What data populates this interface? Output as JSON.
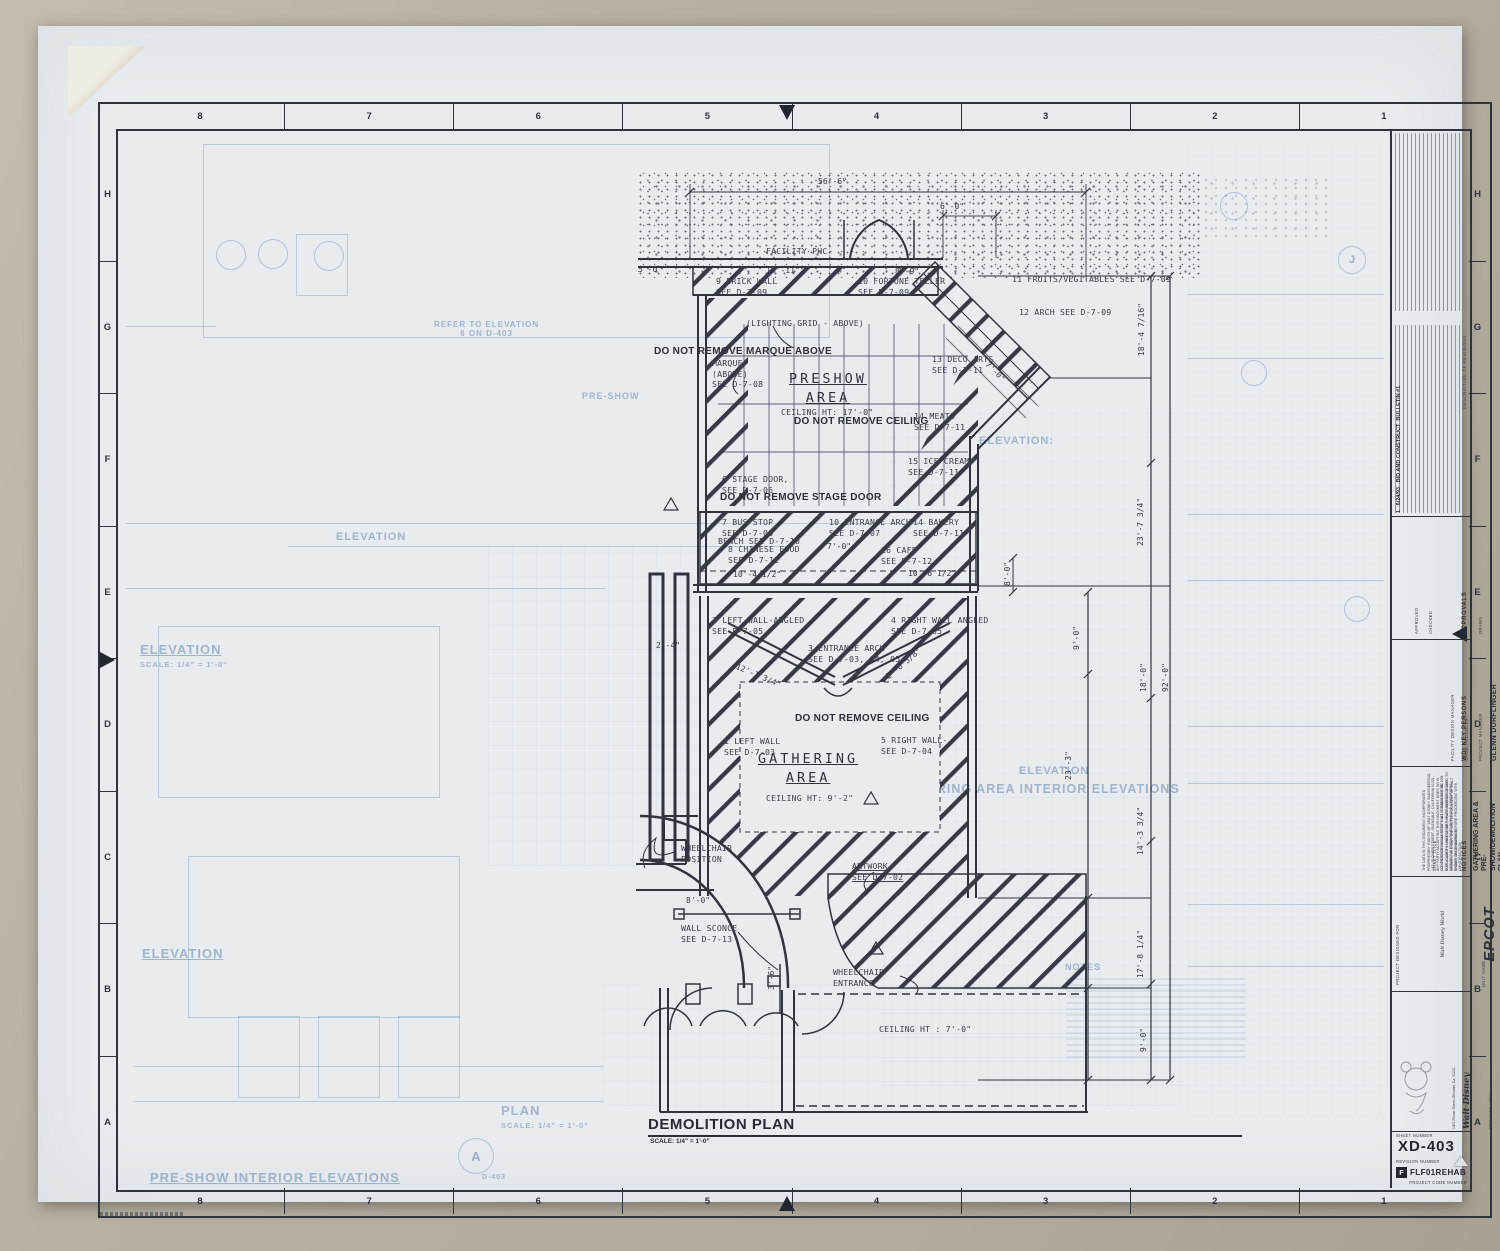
{
  "colors": {
    "ink": "#2f333c",
    "sheet": "#e9ecef",
    "underlay": "#7d9ec4",
    "photo_bg": "#b5afa2"
  },
  "border": {
    "top_numbers": [
      "8",
      "7",
      "6",
      "5",
      "4",
      "3",
      "2",
      "1"
    ],
    "bottom_numbers": [
      "8",
      "7",
      "6",
      "5",
      "4",
      "3",
      "2",
      "1"
    ],
    "left_letters": [
      "H",
      "G",
      "F",
      "E",
      "D",
      "C",
      "B",
      "A"
    ],
    "right_letters": [
      "H",
      "G",
      "F",
      "E",
      "D",
      "C",
      "B",
      "A"
    ]
  },
  "plan": {
    "annotations": [
      {
        "text": "56'-6\""
      },
      {
        "text": "6'-0\""
      },
      {
        "text": "FACILITY PHC"
      },
      {
        "text": "5'-0\""
      },
      {
        "text": "14'-11\""
      },
      {
        "text": "8'-9\""
      },
      {
        "text": "9  BRICK WALL\nSEE D-7-09"
      },
      {
        "text": "10  FORTUNE TELLER\nSEE D-7-09"
      },
      {
        "text": "11  FRUITS/VEGITABLES  SEE D-7-09"
      },
      {
        "text": "12  ARCH    SEE D-7-09"
      },
      {
        "text": "(LIGHTING GRID - ABOVE)"
      },
      {
        "text": "DO NOT REMOVE MARQUE ABOVE"
      },
      {
        "text": "MARQUE\n(ABOVE)\nSEE D-7-08"
      },
      {
        "text": "PRESHOW\nAREA"
      },
      {
        "text": "CEILING HT: 17'-0\""
      },
      {
        "text": "13  DECO ARTS\nSEE D-7-11"
      },
      {
        "text": "7'-0\""
      },
      {
        "text": "DO NOT REMOVE CEILING"
      },
      {
        "text": "14  MEATS\nSEE D-7-11"
      },
      {
        "text": "15  ICE CREAM\nSEE D-7-11"
      },
      {
        "text": "6  STAGE DOOR,\nSEE  D-7-06"
      },
      {
        "text": "DO NOT REMOVE STAGE DOOR"
      },
      {
        "text": "7  BUS STOP\nSEE  D-7-06"
      },
      {
        "text": "BENCH  SEE D-7-10"
      },
      {
        "text": "8  CHINESE FOOD\nSEE D-7-12"
      },
      {
        "text": "10  ENTRANCE ARCH\nSEE  D-7-07"
      },
      {
        "text": "7'-0\""
      },
      {
        "text": "14  BAKERY\nSEE D-7-11"
      },
      {
        "text": "16  CAFE\nSEE  D-7-12"
      },
      {
        "text": "10'-4 1/2\""
      },
      {
        "text": "10'-6 1/2\""
      },
      {
        "text": "8'-0\""
      },
      {
        "text": "2  LEFT WALL-ANGLED\nSEE D-7-05"
      },
      {
        "text": "4  RIGHT WALL ANGLED\nSEE D-7-05"
      },
      {
        "text": "2'-4\""
      },
      {
        "text": "12'-1 3/4\""
      },
      {
        "text": "3  ENTRANCE ARCH\nSEE D-7-03, 04, 05"
      },
      {
        "text": "2'-6 5/8\""
      },
      {
        "text": "9'-0\""
      },
      {
        "text": "DO NOT REMOVE CEILING"
      },
      {
        "text": "1  LEFT WALL\nSEE  D-7-03"
      },
      {
        "text": "5  RIGHT WALL-\nSEE  D-7-04"
      },
      {
        "text": "GATHERING\nAREA"
      },
      {
        "text": "CEILING HT:  9'-2\""
      },
      {
        "text": "23'-3\""
      },
      {
        "text": "WHEELCHAIR\nPOSITION"
      },
      {
        "text": "ARTWORK\nSEE D-7-02"
      },
      {
        "text": "8'-0\""
      },
      {
        "text": "WALL SCONCE\nSEE  D-7-13"
      },
      {
        "text": "3'-6\""
      },
      {
        "text": "WHEELCHAIR\nENTRANCE"
      },
      {
        "text": "CEILING HT : 7'-0\""
      },
      {
        "text": "18'-4 7/16\""
      },
      {
        "text": "23'-7 3/4\""
      },
      {
        "text": "18'-0\""
      },
      {
        "text": "92'-0\""
      },
      {
        "text": "14'-3 3/4\""
      },
      {
        "text": "17'-8 1/4\""
      },
      {
        "text": "9'-0\""
      },
      {
        "text": "DEMOLITION PLAN"
      },
      {
        "text": "SCALE: 1/4\" = 1'-0\""
      }
    ],
    "underlay_labels": [
      {
        "text": "ELEVATION"
      },
      {
        "text": "SCALE: 1/4\" = 1'-0\""
      },
      {
        "text": "REFER TO ELEVATION\n6 ON D-403"
      },
      {
        "text": "ELEVATION"
      },
      {
        "text": "ELEVATION"
      },
      {
        "text": "ELEVATION:"
      },
      {
        "text": "ELEVATION"
      },
      {
        "text": "GATHERING AREA INTERIOR ELEVATIONS"
      },
      {
        "text": "PRE-SHOW INTERIOR ELEVATIONS"
      },
      {
        "text": "PLAN"
      },
      {
        "text": "SCALE: 1/4\" = 1'-0\""
      },
      {
        "text": "NOTES"
      },
      {
        "text": "PRE-SHOW"
      },
      {
        "text": "A"
      },
      {
        "text": "D-403"
      },
      {
        "text": "J"
      }
    ]
  },
  "title_block": {
    "description_of_revisions": "DESCRIPTION OF REVISIONS",
    "revision_entry": "1   6/24/93   BID AND CONSTRUCT  BULLETIN #1",
    "approvals_label": "APPROVALS",
    "drawn_label": "DRAWN",
    "drawn_name": "EARLE MacVEIGH",
    "checked_label": "CHECKED",
    "approved_label": "APPROVED",
    "key_persons_label": "WDI KEY PERSONS",
    "pm_label": "PROJECT MANAGER",
    "pm_name": "DOUG WOLF",
    "producer_label": "SHOW PRODUCER",
    "producer_name": "KATHY ROGERS",
    "fdm_label": "FACILITY DESIGN MANAGER",
    "fdm_name": "GLENN DURFLINGER",
    "notices_label": "NOTICES",
    "notice_1": "THE DATA IN THIS DOCUMENT INCORPORATES PROPRIETARY RIGHTS OF WALT DISNEY IMAGINEERING, 1401 FLOWER STREET, GLENDALE, CALIFORNIA 91221. ANY PARTY ACCEPTING THIS DOCUMENT DOES SO IN CONFIDENCE AND AGREES THAT IT SHALL NOT BE DUPLICATED IN WHOLE OR IN PART, NOR DISCLOSED TO OTHERS, WITHOUT THE WRITTEN CONSENT OF WALT DISNEY IMAGINEERING.",
    "notice_2": "CONTRACTOR SHALL VERIFY ALL CONDITIONS ON JOB SITE & NOTIFY WALT DISNEY IMAGINEERING OF ANY VARIATIONS FROM DIMENSIONS AND CONDITIONS SHOWN ON DRAWING BEFORE PROCEEDING WITH CONSTRUCTION.",
    "sheet_title_label": "SHEET TITLE",
    "sheet_title": "GATHERING AREA &\nPRE-SHOW/DEMOLITION PLAN",
    "designed_for_label": "PROJECT DESIGNED FOR",
    "epcot_top": "Walt Disney World",
    "epcot_main": "EPCOT",
    "epcot_sub": "CENTER",
    "unit_name_label": "UNIT NAME",
    "unit_name": "LAND PAVILLION",
    "wdi_logo_line1": "Walt Disney",
    "wdi_logo_line2": "Imagineering.",
    "wdi_address": "1401 Flower Street, Glendale, Ca. 91221",
    "wdi_address2": "The Walt Disney Company",
    "project_area_label": "PROJECT AREA",
    "project_area": "FUTURE WORLD",
    "sheet_number_label": "SHEET NUMBER",
    "sheet_number": "XD-403",
    "revision_number_label": "REVISION NUMBER",
    "code_letter": "F",
    "project_code": "FLF01REHAB",
    "project_code_label": "PROJECT CODE NUMBER"
  }
}
